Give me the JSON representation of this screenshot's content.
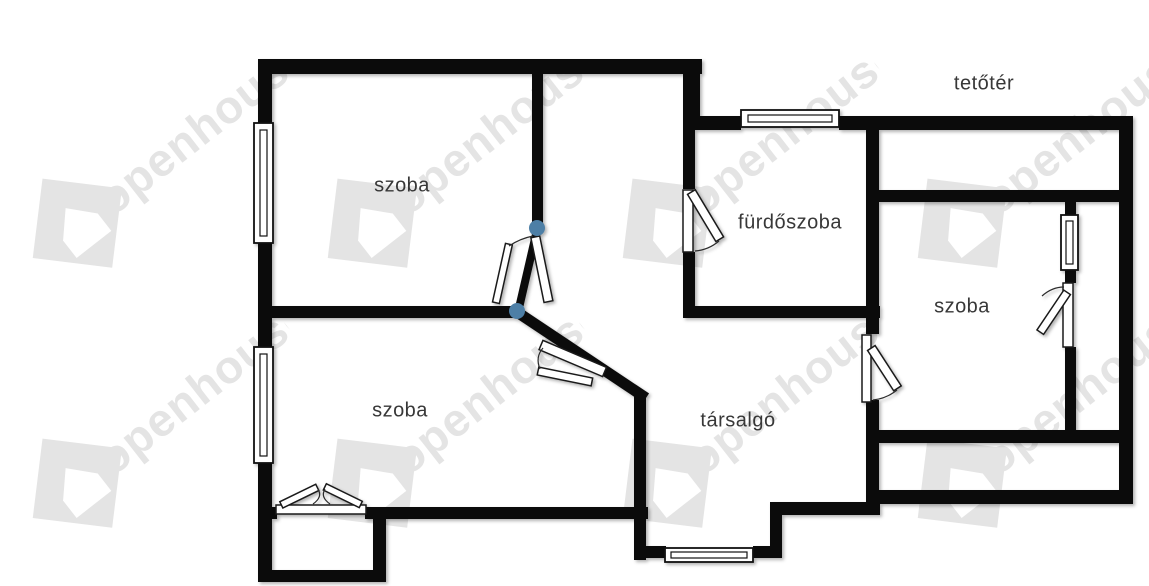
{
  "watermark": {
    "text": "openhouse"
  },
  "colors": {
    "wall": "#0b0b0b",
    "marker": "#4d7fa6",
    "watermark_gray": "#e4e4e4",
    "label_text": "#383838"
  },
  "labels": {
    "attic": "tetőtér",
    "room_top_left": "szoba",
    "bathroom": "fürdőszoba",
    "room_right": "szoba",
    "room_bottom_left": "szoba",
    "lounge": "társalgó"
  }
}
